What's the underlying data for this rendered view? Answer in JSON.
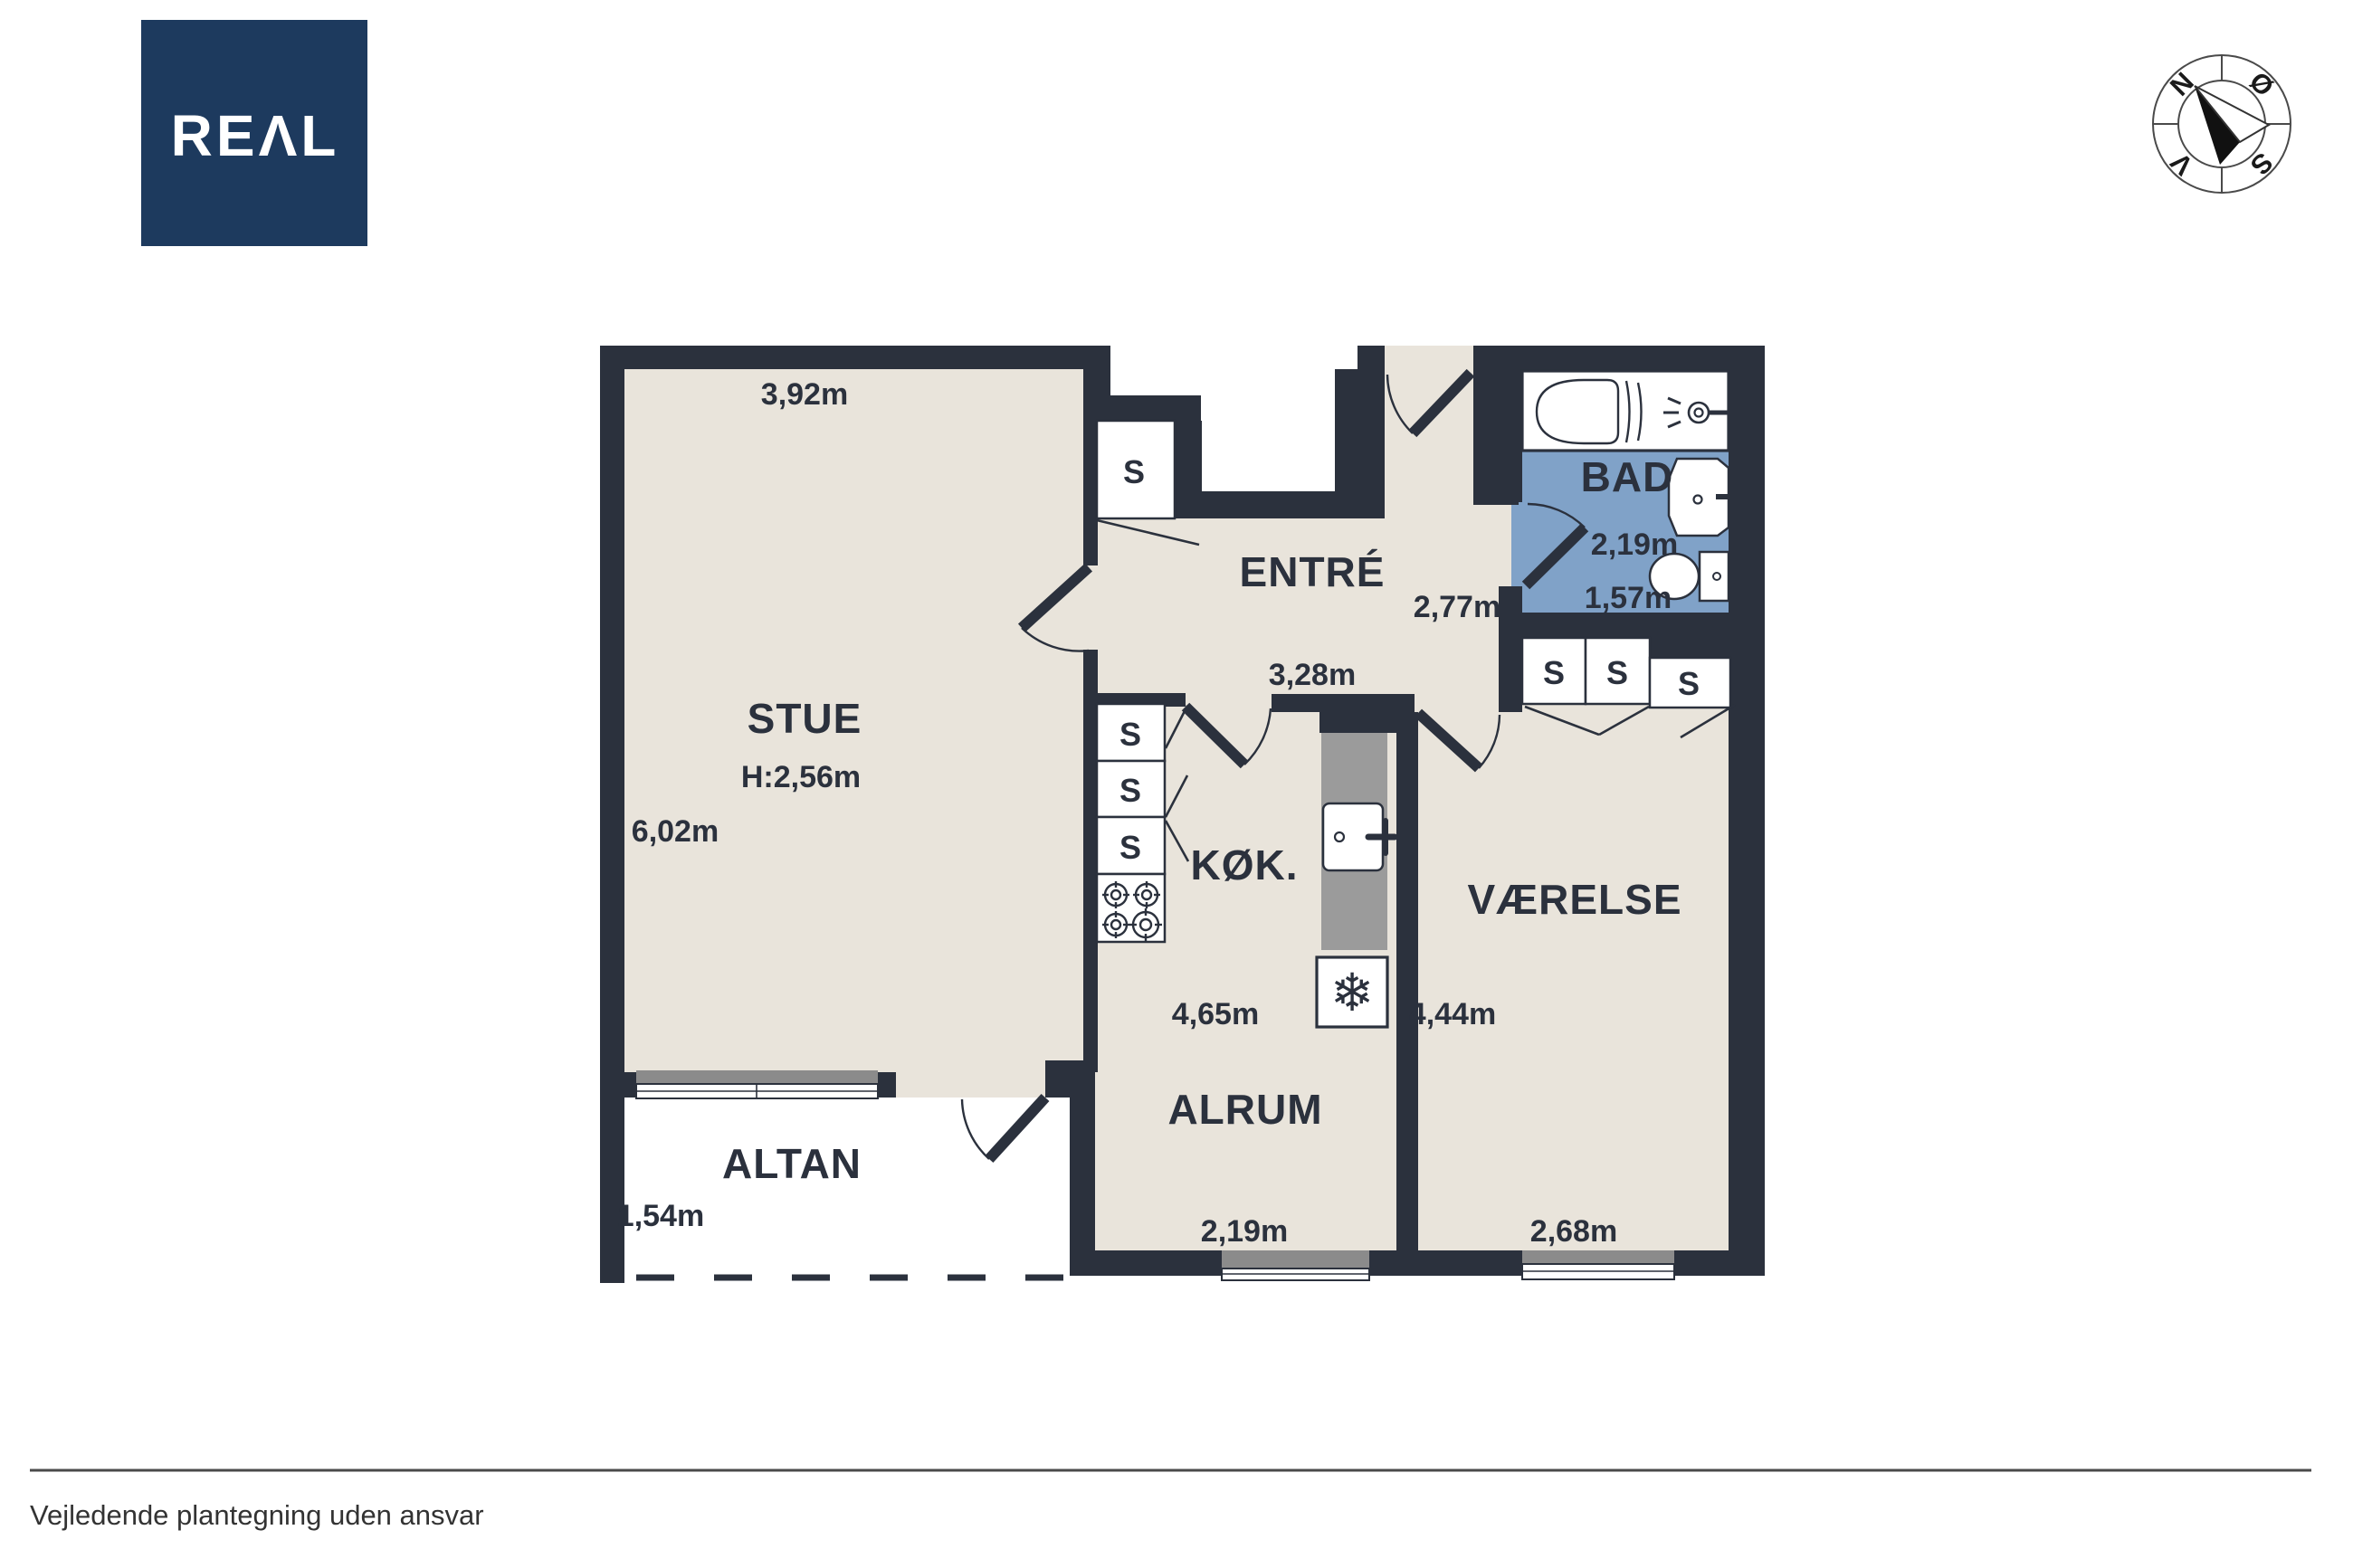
{
  "logo": {
    "text": "REAL",
    "display": "REΛL",
    "color": "#1d3a5e"
  },
  "compass": {
    "n": "N",
    "e": "Ø",
    "s": "S",
    "w": "V"
  },
  "rooms": {
    "stue": {
      "name": "STUE",
      "ceiling_height": "H:2,56m",
      "width": "3,92m",
      "length": "6,02m"
    },
    "entre": {
      "name": "ENTRÉ",
      "width": "2,77m",
      "length": "3,28m"
    },
    "bad": {
      "name": "BAD",
      "width": "2,19m",
      "length": "1,57m"
    },
    "kok": {
      "name": "KØK.",
      "length": "4,65m"
    },
    "vaerelse": {
      "name": "VÆRELSE",
      "length": "4,44m",
      "width": "2,68m"
    },
    "alrum": {
      "name": "ALRUM",
      "width": "2,19m"
    },
    "altan": {
      "name": "ALTAN",
      "depth": "1,54m"
    }
  },
  "closet_label": "S",
  "icons": {
    "freezer": "❄"
  },
  "footer": {
    "disclaimer": "Vejledende plantegning uden ansvar"
  },
  "colors": {
    "wall": "#2b313d",
    "floor": "#e9e4db",
    "bathroom_floor": "#80a2c8",
    "counter": "#9b9b9b",
    "window_sill": "#8b8b8b",
    "logo_navy": "#1d3a5e"
  }
}
